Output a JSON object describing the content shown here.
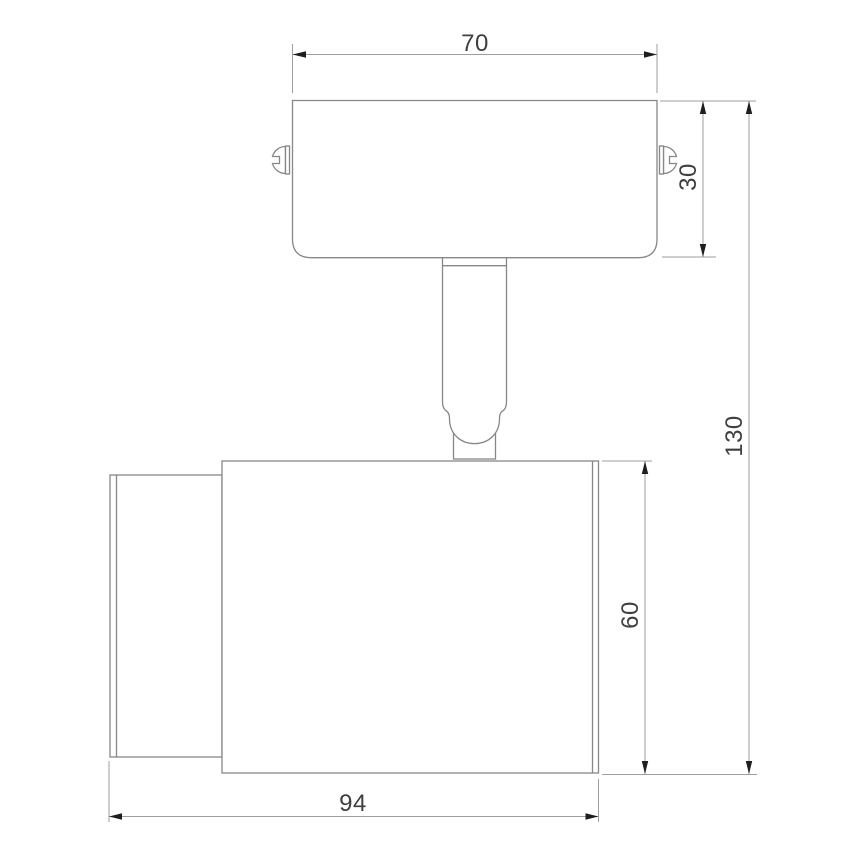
{
  "drawing": {
    "subject": "spot-light-fixture-side-view-technical-drawing",
    "background_color": "#ffffff",
    "line_color": "#878787",
    "dimension_line_color": "#9e9e9e",
    "text_color": "#3f3f3f",
    "arrow_color": "#1e1e1e",
    "dimensions": {
      "bracket_width": "70",
      "bracket_height": "30",
      "overall_height": "130",
      "body_height": "60",
      "body_length": "94"
    }
  }
}
